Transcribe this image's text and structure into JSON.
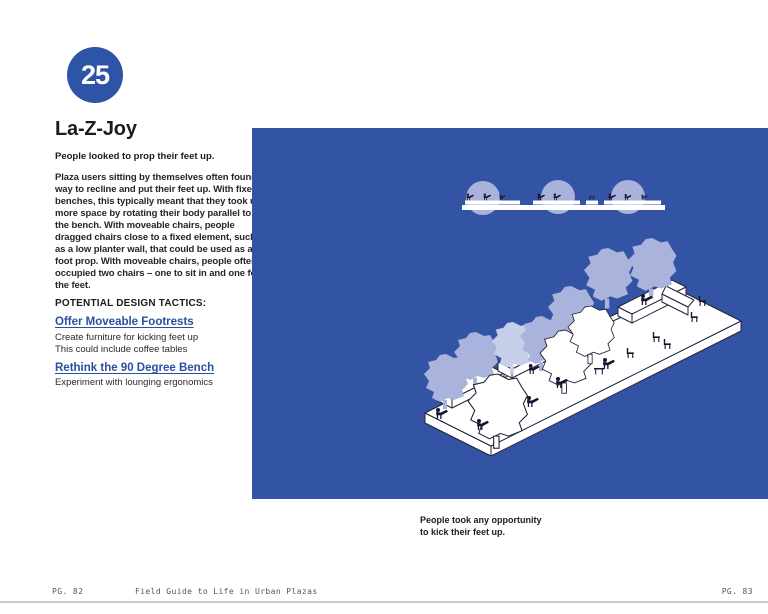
{
  "page": {
    "badge": {
      "number": "25",
      "color": "#2d54a6"
    },
    "title": "La-Z-Joy",
    "lede": "People looked to prop their feet up.",
    "body": "Plaza users sitting by themselves often found a way to recline and put their feet up. With fixed benches, this typically meant that they took up more space by rotating their body parallel to the bench. With moveable chairs, people dragged chairs close to a fixed element, such as a low planter wall, that could be used as a foot prop. With moveable chairs, people often occupied two chairs – one to sit in and one for the feet.",
    "tactics_heading": "POTENTIAL DESIGN TACTICS:",
    "tactics": [
      {
        "link": "Offer Moveable Footrests",
        "desc": [
          "Create furniture for kicking feet up",
          "This could include coffee tables"
        ]
      },
      {
        "link": "Rethink the 90 Degree Bench",
        "desc": [
          "Experiment with lounging ergonomics"
        ]
      }
    ],
    "figure": {
      "caption_line1": "People took any opportunity",
      "caption_line2": "to kick their feet up.",
      "panel_color": "#3354a5",
      "highlight_color": "#a8b2da",
      "silhouette_color": "#15152e",
      "description": "isometric-plaza-with-benches-trees-and-people-kicking-feet-up"
    },
    "footer": {
      "left_page": "PG. 82",
      "book_title": "Field Guide to Life in Urban Plazas",
      "right_page": "PG. 83"
    }
  }
}
